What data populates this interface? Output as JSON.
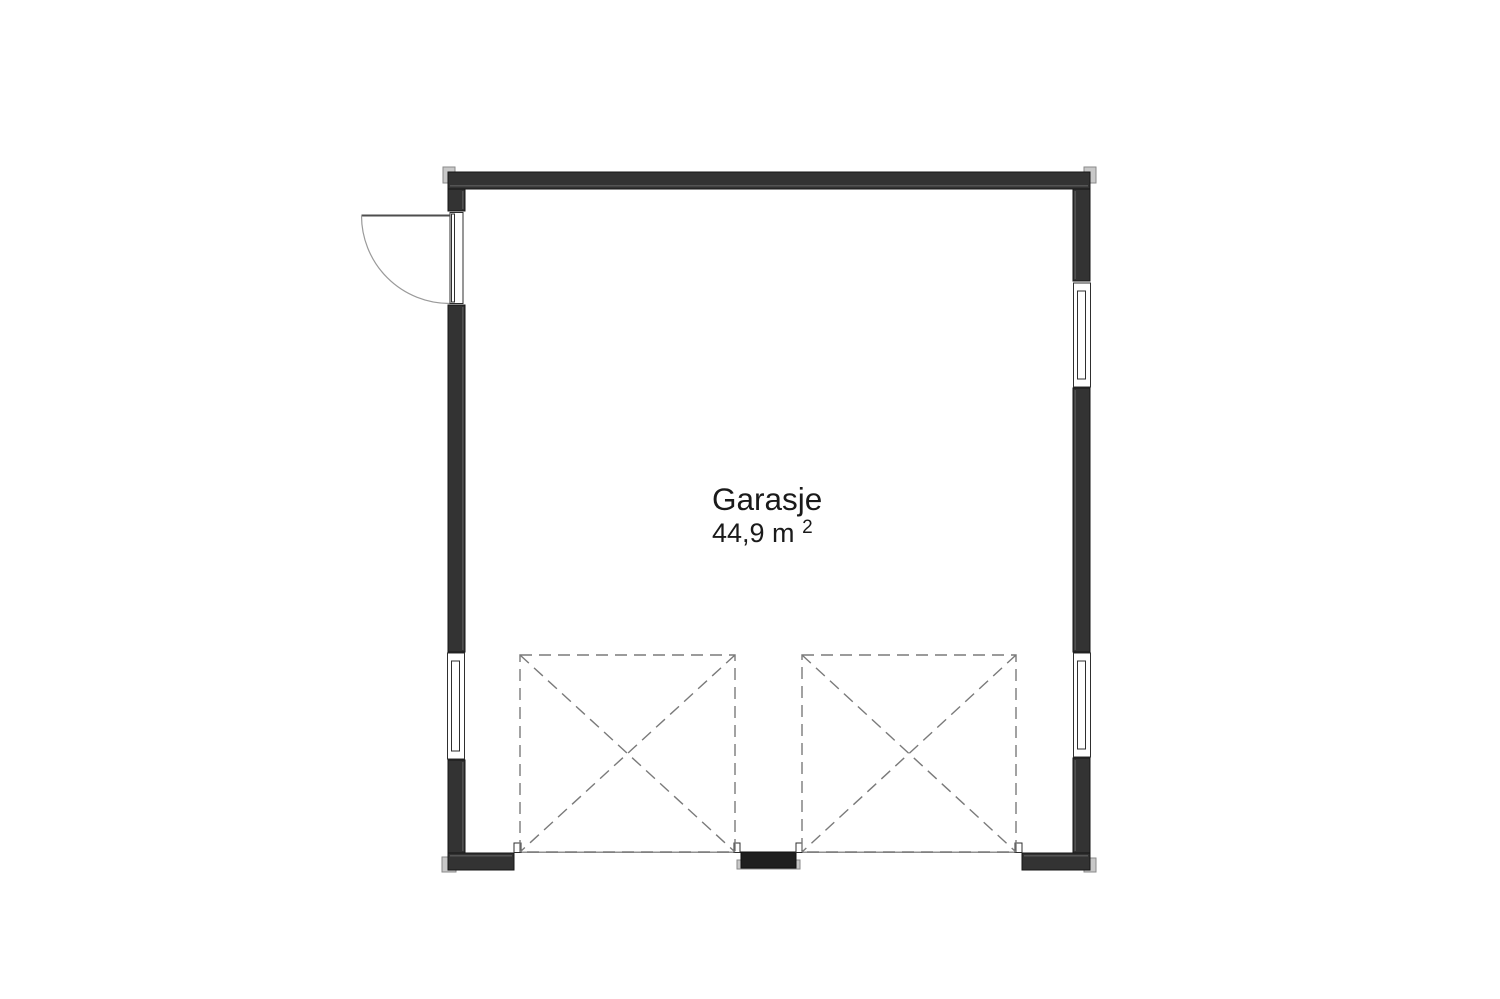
{
  "plan": {
    "room_label": "Garasje",
    "room_area": "44,9 m",
    "room_area_exponent": "2",
    "colors": {
      "wall": "#333333",
      "wall_dark": "#1f1f1f",
      "wall_highlight": "#545454",
      "trim": "#c8c8c8",
      "frame_line": "#2f2f2f",
      "dashed_line": "#7a7a7a",
      "door_arc": "#9a9a9a",
      "door_leaf": "#4d4d4d",
      "threshold": "#909090",
      "text": "#1a1a1a",
      "background": "#ffffff"
    }
  }
}
